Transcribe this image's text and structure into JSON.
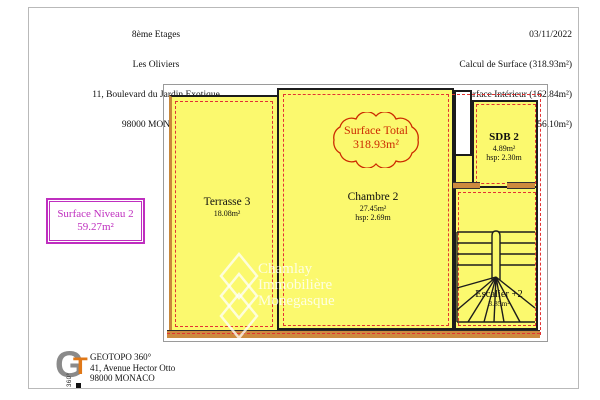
{
  "header_left": {
    "lines": [
      "8ème Etages",
      "Les Oliviers",
      "11, Boulevard du Jardin Exotique",
      "98000 MONACO"
    ]
  },
  "header_right": {
    "lines": [
      "03/11/2022",
      "Calcul de Surface (318.93m²)",
      "Surface Intérieur (162.84m²)",
      "Surface Extérieur (156.10m²)"
    ]
  },
  "level_summary": {
    "title": "Surface Niveau 2",
    "value": "59.27m²"
  },
  "surface_total": {
    "title": "Surface Total",
    "value": "318.93m²"
  },
  "rooms": {
    "terrasse": {
      "name": "Terrasse 3",
      "area": "18.08m²"
    },
    "chambre": {
      "name": "Chambre 2",
      "area": "27.45m²",
      "hsp": "hsp: 2.69m"
    },
    "sdb": {
      "name": "SDB 2",
      "area": "4.89m²",
      "hsp": "hsp: 2.30m"
    },
    "escalier": {
      "name": "Escalier +2",
      "area": "3.85m²"
    }
  },
  "watermark": {
    "lines": [
      "Chamlay",
      "Immobilière",
      "Monegasque"
    ]
  },
  "footer": {
    "company": "GEOTOPO 360°",
    "address": "41, Avenue Hector Otto",
    "city": "98000 MONACO",
    "logo": {
      "g": "G",
      "t": "T",
      "rotated": "360°"
    }
  },
  "colors": {
    "room_fill": "#fbf96e",
    "wall": "#1c1c1c",
    "measure_dash": "#e23333",
    "door_tan": "#cd8a3e",
    "level_magenta": "#bf2fbf",
    "cloud_red": "#cc2a00",
    "frame_gray": "#9a9a9a",
    "logo_gray": "#8a8a8a",
    "logo_orange": "#e07818"
  }
}
